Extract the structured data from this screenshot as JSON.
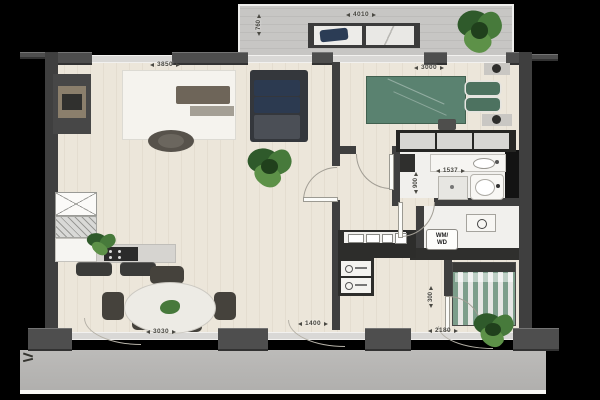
{
  "scene": {
    "type": "apartment-floor-plan",
    "background": "#000000"
  },
  "palette": {
    "wall": "#3f3f3f",
    "wood_floor": "#ece6da",
    "balcony_floor": "#c7c6c4",
    "gallery_floor": "#b6b5b3",
    "bed_green": "#5a8270",
    "sofa_navy": "#2c3a50",
    "plant_green": "#477a3b",
    "fixture_white": "#f6f5f2"
  },
  "dims": {
    "balcony_width": "4010",
    "balcony_depth": "760",
    "living_width": "3850",
    "bedroom_width": "3000",
    "bathroom_width": "1537",
    "shower_width": "900",
    "dining_width": "3030",
    "entry_width": "1400",
    "bedroom2_width": "2180",
    "closet_depth": "300"
  },
  "labels": {
    "washer_dryer_line1": "WM/",
    "washer_dryer_line2": "WD"
  }
}
